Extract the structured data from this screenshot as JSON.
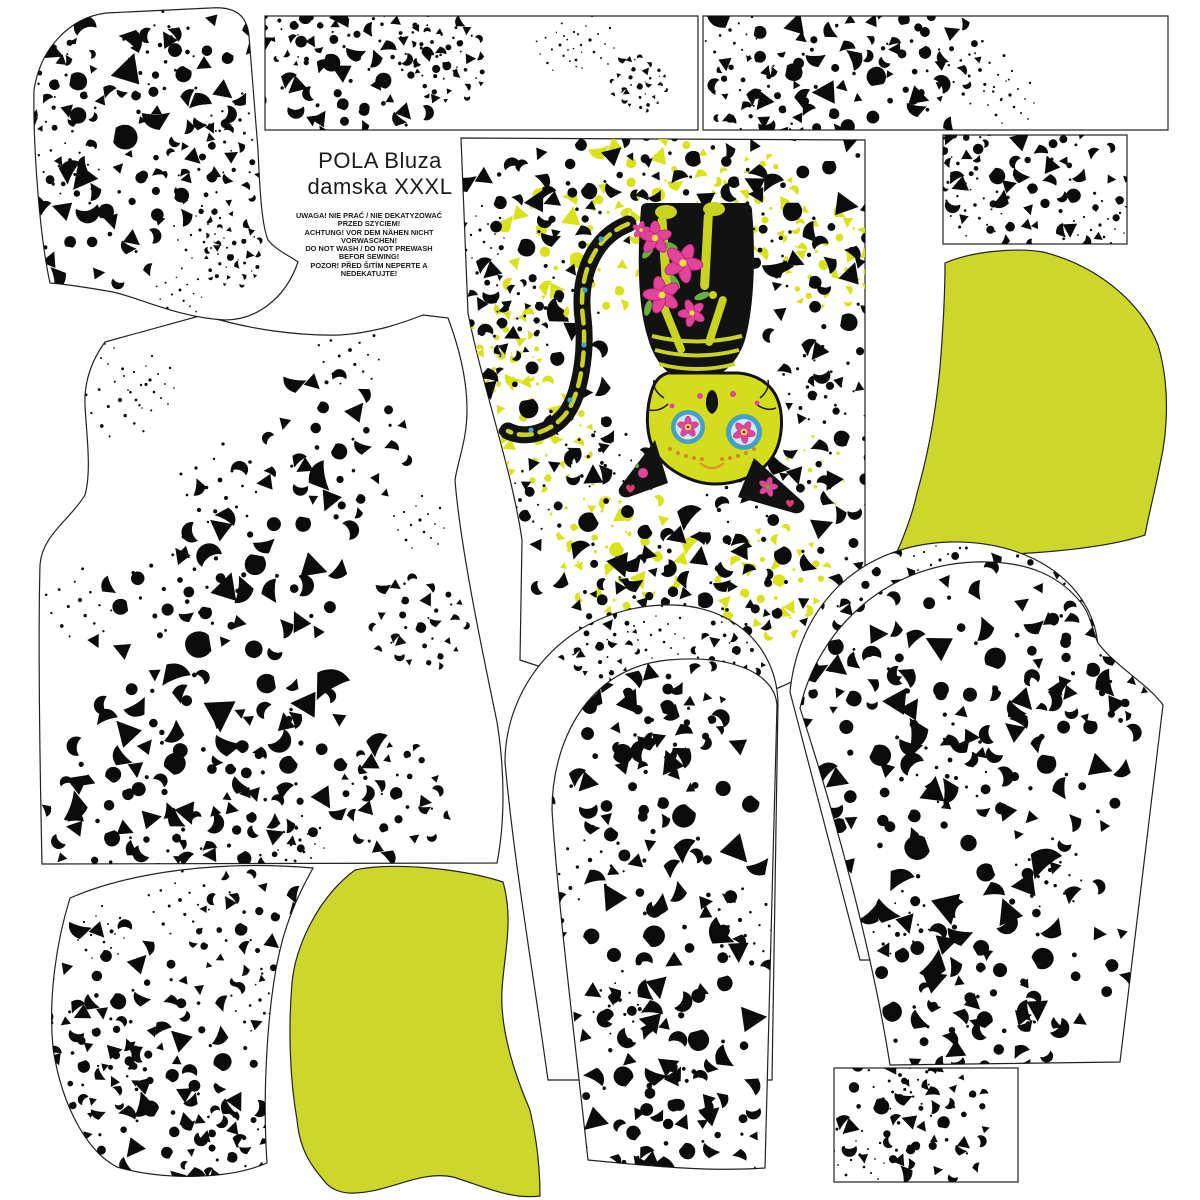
{
  "document": {
    "title_line1": "POLA Bluza",
    "title_line2": "damska XXXL",
    "warning_lines": [
      "UWAGA! NIE PRAĆ / NIE DEKATYZOWAĆ",
      "PRZED SZYCIEM!",
      "ACHTUNG! VOR DEM NÄHEN NICHT",
      "VORWASCHEN!",
      "DO NOT WASH / DO NOT PREWASH",
      "BEFOR SEWING!",
      "POZOR! PŘED ŠITÍM NEPERTE A",
      "NEDEKATUJTE!"
    ]
  },
  "colors": {
    "background": "#ffffff",
    "outline": "#222222",
    "splatter_black": "#0b0b0b",
    "lime_piece": "#cdd62b",
    "lime_splatter": "#d9e31c",
    "cat_black": "#121212",
    "bone_yellow": "#c9d321",
    "face_lime": "#d4dc1e",
    "flower_pink": "#e0459c",
    "flower_deep_pink": "#c22577",
    "leaf_green": "#6aae3e",
    "eye_teal": "#42a2c6",
    "eye_inner": "#cfe8f2",
    "eye_center_yellow": "#f0dd3a",
    "heart_red": "#e03a6e",
    "whisker_orange": "#d4862a"
  },
  "pieces": [
    {
      "id": "hood-side-print",
      "label": "hood side piece, speckle print"
    },
    {
      "id": "binding-strip-1",
      "label": "binding strip"
    },
    {
      "id": "binding-strip-2",
      "label": "binding strip"
    },
    {
      "id": "cuff-rectangle-top",
      "label": "cuff rectangle"
    },
    {
      "id": "front-panel-cat",
      "label": "center panel with sugar-skull cat print"
    },
    {
      "id": "bodice",
      "label": "bodice front/back piece"
    },
    {
      "id": "hood-side-lime",
      "label": "hood side piece, lime"
    },
    {
      "id": "sleeve-center-back",
      "label": "sleeve underlay"
    },
    {
      "id": "sleeve-center-front",
      "label": "sleeve"
    },
    {
      "id": "sleeve-right-back",
      "label": "sleeve underlay"
    },
    {
      "id": "sleeve-right-front",
      "label": "sleeve"
    },
    {
      "id": "pocket-piece-print",
      "label": "pocket piece, speckle print"
    },
    {
      "id": "pocket-piece-lime",
      "label": "pocket piece, lime"
    },
    {
      "id": "cuff-rectangle-bottom",
      "label": "cuff rectangle"
    }
  ]
}
